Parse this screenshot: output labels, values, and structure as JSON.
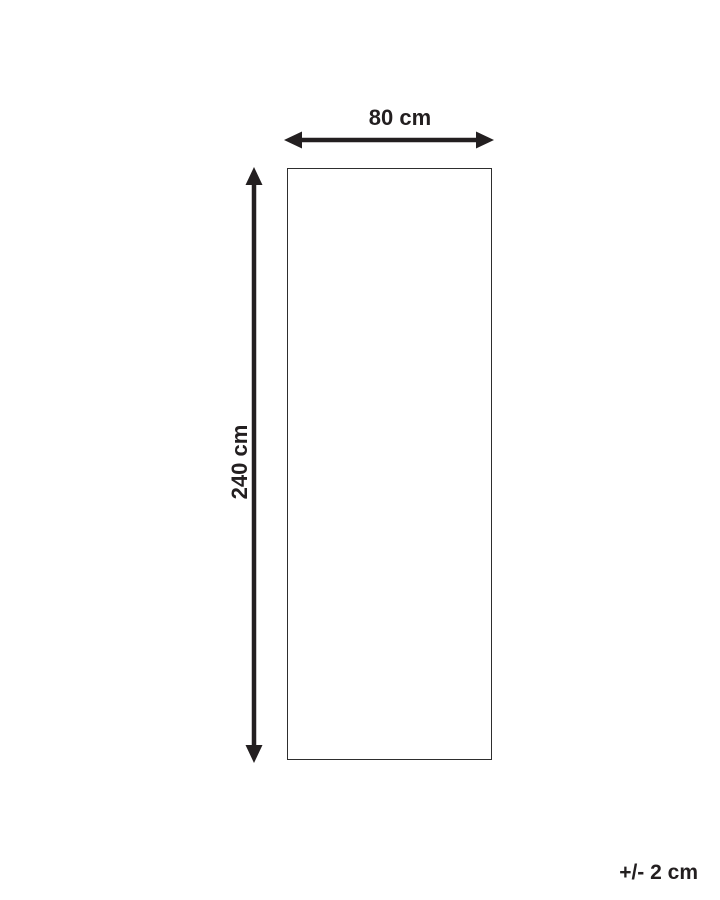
{
  "diagram": {
    "width_label": "80 cm",
    "height_label": "240 cm",
    "tolerance_label": "+/- 2 cm",
    "colors": {
      "ink": "#231f20",
      "outline": "#2e2e2e",
      "background": "#ffffff"
    }
  }
}
